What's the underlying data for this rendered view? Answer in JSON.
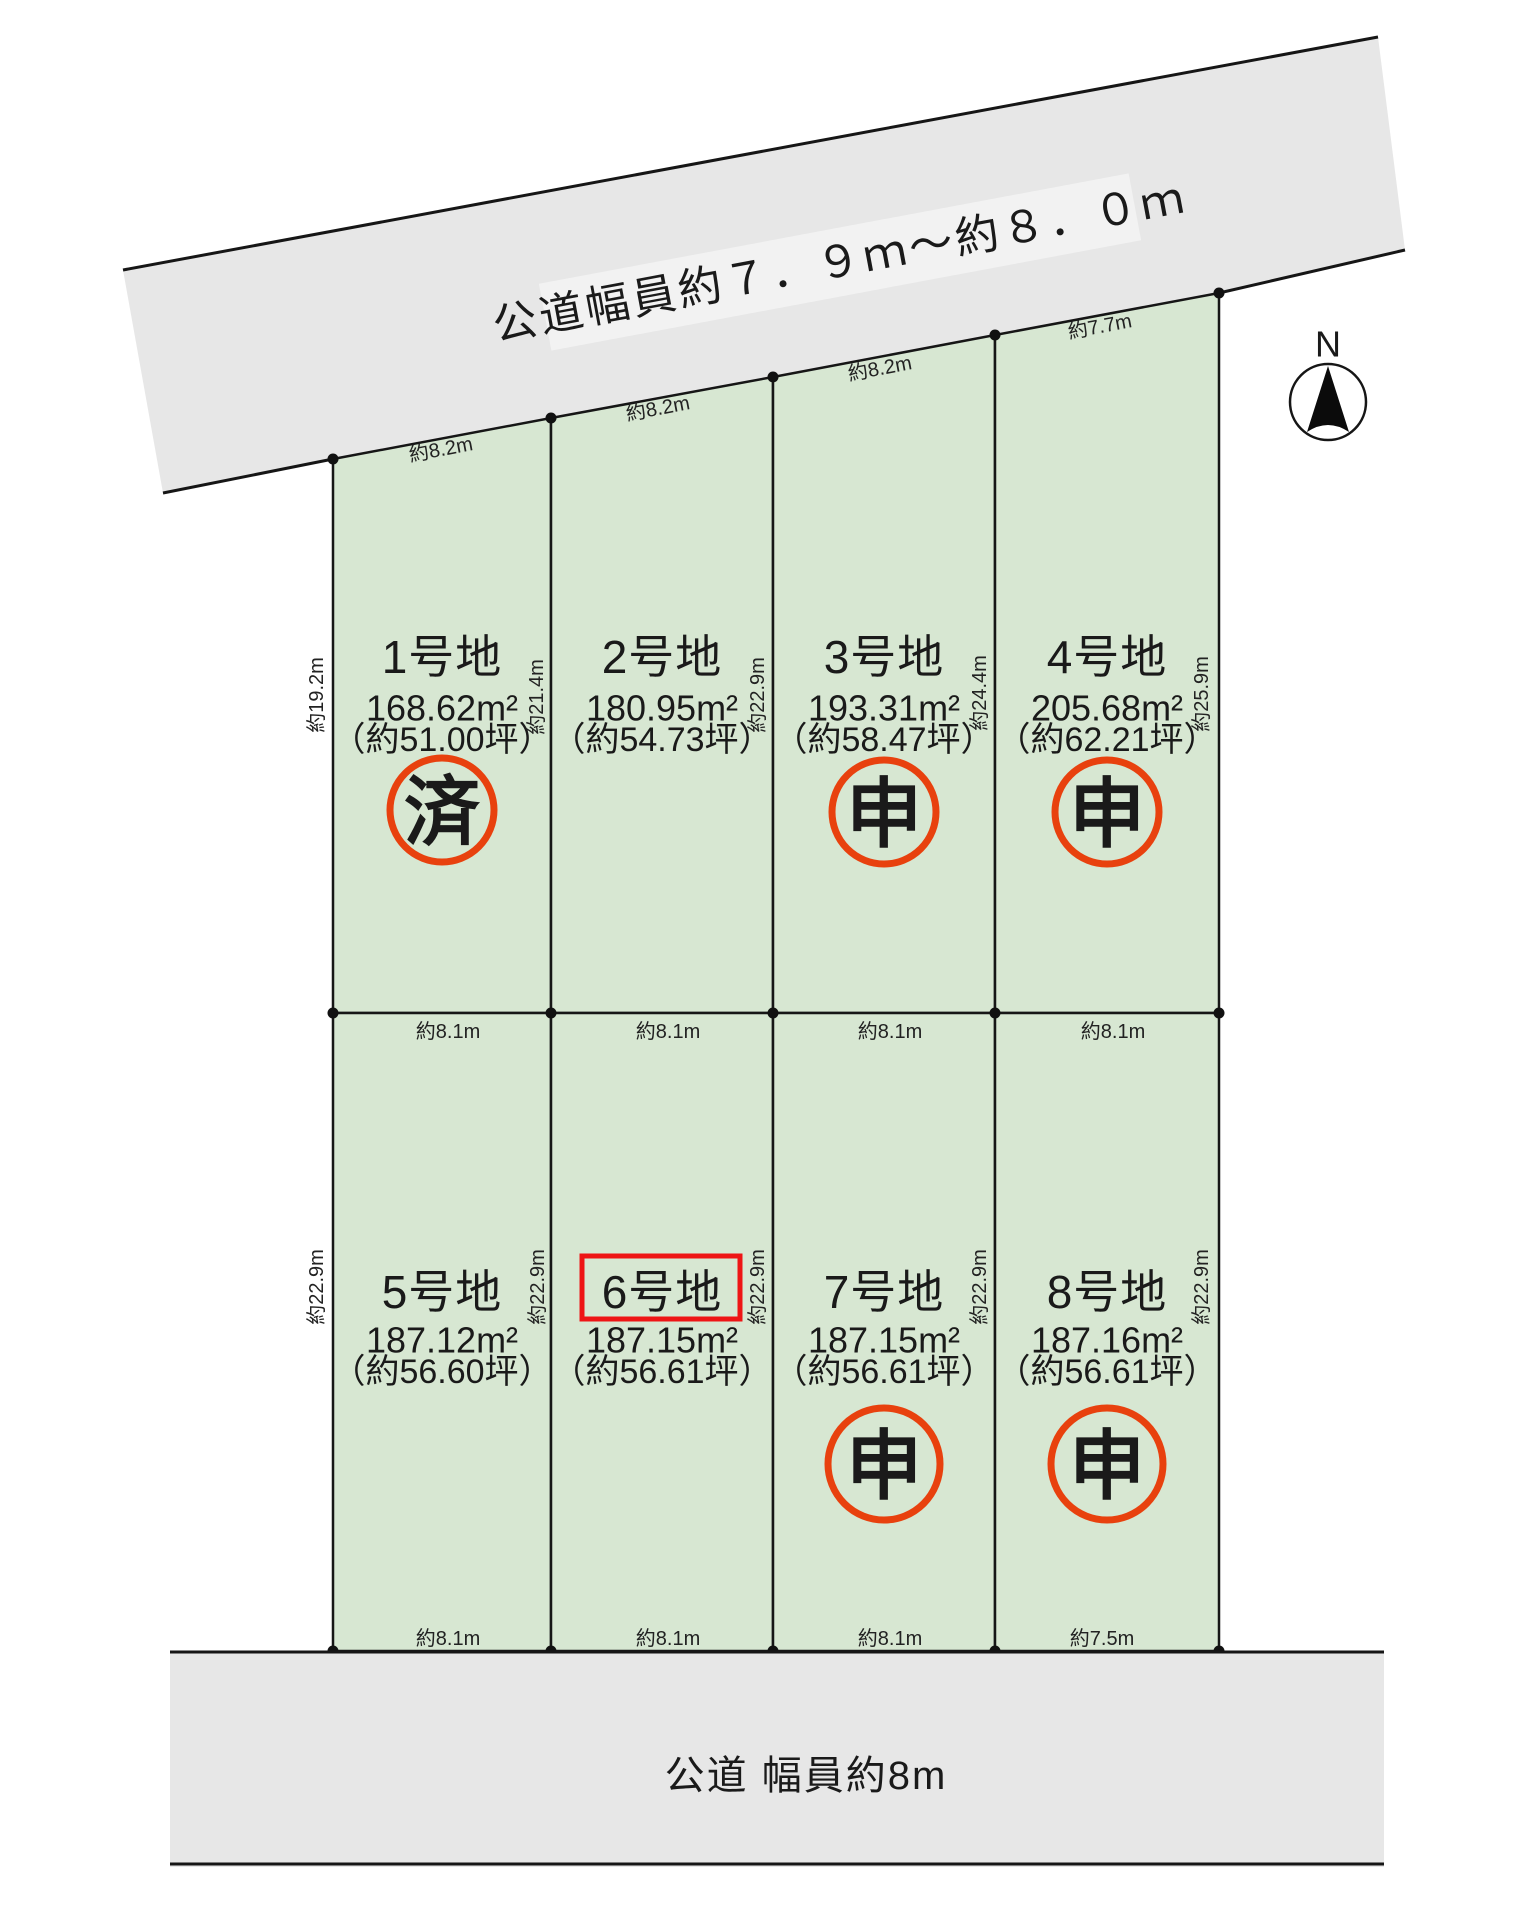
{
  "roads": {
    "top_label": "公道幅員約７．９ｍ～約８．０ｍ",
    "bottom_label": "公道 幅員約8m"
  },
  "compass": {
    "north_label": "N"
  },
  "plots": [
    {
      "name": "1号地",
      "area": "168.62m²",
      "tsubo": "（約51.00坪）",
      "stamp": "済",
      "highlight": false
    },
    {
      "name": "2号地",
      "area": "180.95m²",
      "tsubo": "（約54.73坪）",
      "stamp": null,
      "highlight": false
    },
    {
      "name": "3号地",
      "area": "193.31m²",
      "tsubo": "（約58.47坪）",
      "stamp": "申",
      "highlight": false
    },
    {
      "name": "4号地",
      "area": "205.68m²",
      "tsubo": "（約62.21坪）",
      "stamp": "申",
      "highlight": false
    },
    {
      "name": "5号地",
      "area": "187.12m²",
      "tsubo": "（約56.60坪）",
      "stamp": null,
      "highlight": false
    },
    {
      "name": "6号地",
      "area": "187.15m²",
      "tsubo": "（約56.61坪）",
      "stamp": null,
      "highlight": true
    },
    {
      "name": "7号地",
      "area": "187.15m²",
      "tsubo": "（約56.61坪）",
      "stamp": "申",
      "highlight": false
    },
    {
      "name": "8号地",
      "area": "187.16m²",
      "tsubo": "（約56.61坪）",
      "stamp": "申",
      "highlight": false
    }
  ],
  "dims": {
    "top": [
      "約8.2m",
      "約8.2m",
      "約8.2m",
      "約7.7m"
    ],
    "middle": [
      "約8.1m",
      "約8.1m",
      "約8.1m",
      "約8.1m"
    ],
    "bottom": [
      "約8.1m",
      "約8.1m",
      "約8.1m",
      "約7.5m"
    ],
    "row1_sides": [
      "約19.2m",
      "約21.4m",
      "約22.9m",
      "約24.4m",
      "約25.9m"
    ],
    "row2_sides": [
      "約22.9m",
      "約22.9m",
      "約22.9m",
      "約22.9m",
      "約22.9m"
    ]
  },
  "colors": {
    "plot_green": "#d7e7d2",
    "road_gray": "#e7e7e7",
    "stamp_orange": "#e8410e",
    "highlight_red": "#ee1515",
    "line_black": "#161616"
  }
}
